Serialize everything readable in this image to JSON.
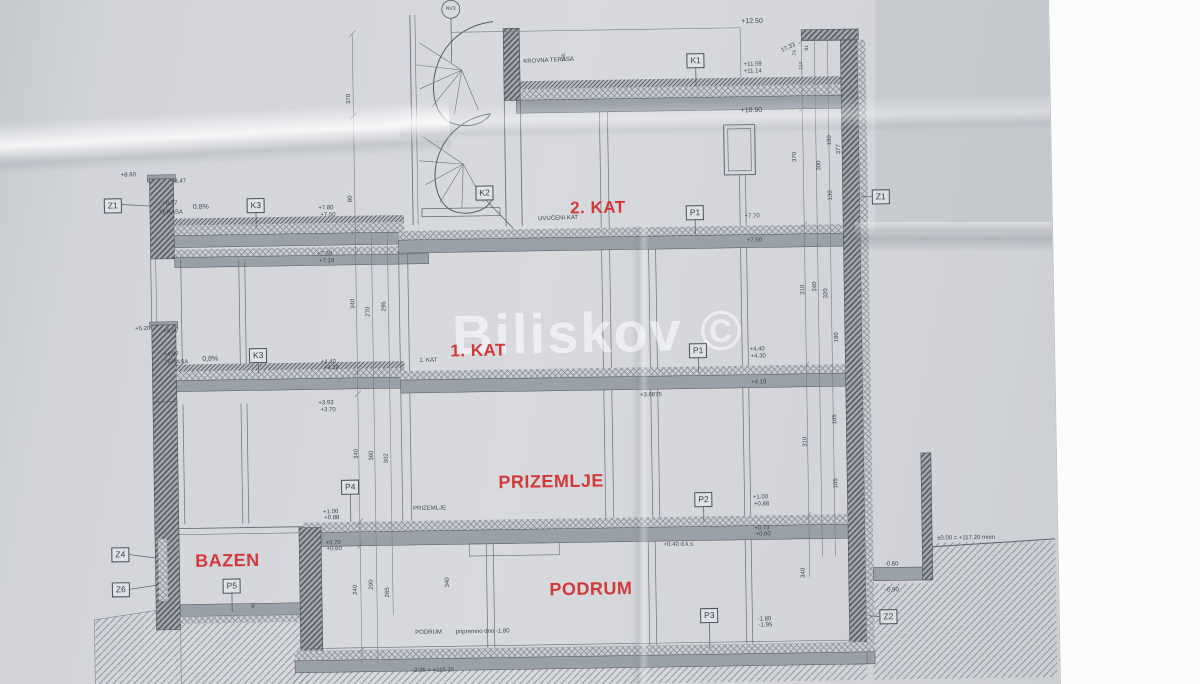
{
  "watermark": {
    "text": "Biliskov ©"
  },
  "colors": {
    "label_red": "#d23a3a",
    "line": "#60646c",
    "paper": "#d2d4d9"
  },
  "drawing": {
    "room_labels": [
      {
        "t": "2. KAT",
        "x": 600,
        "y": 208,
        "s": 17
      },
      {
        "t": "1. KAT",
        "x": 478,
        "y": 349,
        "s": 17
      },
      {
        "t": "PRIZEMLJE",
        "x": 549,
        "y": 481,
        "s": 18
      },
      {
        "t": "PODRUM",
        "x": 587,
        "y": 589,
        "s": 18
      },
      {
        "t": "BAZEN",
        "x": 224,
        "y": 555,
        "s": 18
      }
    ],
    "tags": [
      {
        "t": "K1",
        "x": 700,
        "y": 62
      },
      {
        "t": "K2",
        "x": 487,
        "y": 191
      },
      {
        "t": "K3",
        "x": 258,
        "y": 200
      },
      {
        "t": "K3",
        "x": 258,
        "y": 350
      },
      {
        "t": "P1",
        "x": 697,
        "y": 214
      },
      {
        "t": "P1",
        "x": 698,
        "y": 352
      },
      {
        "t": "P2",
        "x": 701,
        "y": 501
      },
      {
        "t": "P3",
        "x": 705,
        "y": 617
      },
      {
        "t": "P4",
        "x": 348,
        "y": 483
      },
      {
        "t": "P5",
        "x": 228,
        "y": 580
      },
      {
        "t": "Z1",
        "x": 115,
        "y": 198
      },
      {
        "t": "Z1",
        "x": 883,
        "y": 201
      },
      {
        "t": "Z4",
        "x": 117,
        "y": 547
      },
      {
        "t": "Z6",
        "x": 117,
        "y": 582
      },
      {
        "t": "Z2",
        "x": 884,
        "y": 621
      }
    ],
    "annotations": [
      {
        "t": "NV3",
        "x": 456,
        "y": 7,
        "s": 5
      },
      {
        "t": "KROVNA TERASA",
        "x": 553,
        "y": 60,
        "r": -2
      },
      {
        "t": "135",
        "x": 569,
        "y": 57,
        "r": -90,
        "s": 5
      },
      {
        "t": "UVUČENI KAT",
        "x": 560,
        "y": 218,
        "r": -1
      },
      {
        "t": "TERASA",
        "x": 173,
        "y": 206
      },
      {
        "t": "0,8%",
        "x": 203,
        "y": 201,
        "s": 7
      },
      {
        "t": "TERASA",
        "x": 176,
        "y": 356
      },
      {
        "t": "0,8%",
        "x": 210,
        "y": 353,
        "s": 7
      },
      {
        "t": "1. KAT",
        "x": 428,
        "y": 358
      },
      {
        "t": "PRIZEMLJE",
        "x": 427,
        "y": 506
      },
      {
        "t": "PODRUM",
        "x": 424,
        "y": 630
      },
      {
        "t": "pripremno dno -1,80",
        "x": 478,
        "y": 630
      },
      {
        "t": "+12.50",
        "x": 757,
        "y": 24,
        "s": 7
      },
      {
        "t": "17,33",
        "x": 793,
        "y": 51,
        "r": -25
      },
      {
        "t": "+11.59",
        "x": 757,
        "y": 67
      },
      {
        "t": "+11.14",
        "x": 757,
        "y": 74
      },
      {
        "t": "+10.90",
        "x": 755,
        "y": 113,
        "s": 7
      },
      {
        "t": "+8.60",
        "x": 131,
        "y": 168
      },
      {
        "t": "+8.47",
        "x": 181,
        "y": 175
      },
      {
        "t": "+8.37",
        "x": 172,
        "y": 197
      },
      {
        "t": "+7.80",
        "x": 328,
        "y": 204
      },
      {
        "t": "+7.50",
        "x": 330,
        "y": 211
      },
      {
        "t": "+7.30",
        "x": 326,
        "y": 250
      },
      {
        "t": "+7.10",
        "x": 328,
        "y": 257
      },
      {
        "t": "+7.70",
        "x": 754,
        "y": 219
      },
      {
        "t": "+7.50",
        "x": 756,
        "y": 243
      },
      {
        "t": "+5.20",
        "x": 143,
        "y": 322
      },
      {
        "t": "+5.07",
        "x": 171,
        "y": 325
      },
      {
        "t": "+4.97",
        "x": 171,
        "y": 348
      },
      {
        "t": "+4.40",
        "x": 328,
        "y": 358
      },
      {
        "t": "+4.10",
        "x": 331,
        "y": 364
      },
      {
        "t": "+3.93",
        "x": 325,
        "y": 399
      },
      {
        "t": "+3.70",
        "x": 327,
        "y": 406
      },
      {
        "t": "+4.40",
        "x": 757,
        "y": 352
      },
      {
        "t": "+4.30",
        "x": 758,
        "y": 359
      },
      {
        "t": "+4.10",
        "x": 758,
        "y": 385
      },
      {
        "t": "+3.8875",
        "x": 650,
        "y": 396
      },
      {
        "t": "+1.00",
        "x": 758,
        "y": 500
      },
      {
        "t": "+0.88",
        "x": 759,
        "y": 507
      },
      {
        "t": "+0.73",
        "x": 759,
        "y": 531
      },
      {
        "t": "+0.60",
        "x": 760,
        "y": 537
      },
      {
        "t": "+0.40 d.k.s.",
        "x": 676,
        "y": 546
      },
      {
        "t": "+1.00",
        "x": 328,
        "y": 508
      },
      {
        "t": "+0.88",
        "x": 329,
        "y": 514
      },
      {
        "t": "+0.70",
        "x": 330,
        "y": 539
      },
      {
        "t": "+0.60",
        "x": 331,
        "y": 545
      },
      {
        "t": "-1.80",
        "x": 760,
        "y": 622
      },
      {
        "t": "-1.95",
        "x": 761,
        "y": 628
      },
      {
        "t": "±0.00 = +117.20 mnm",
        "x": 963,
        "y": 544
      },
      {
        "t": "-0.60",
        "x": 888,
        "y": 569
      },
      {
        "t": "-0.90",
        "x": 888,
        "y": 595
      },
      {
        "t": "-2.05 = +115.15",
        "x": 428,
        "y": 668
      },
      {
        "t": "370",
        "x": 353,
        "y": 95,
        "r": -90
      },
      {
        "t": "80",
        "x": 353,
        "y": 195,
        "r": -90
      },
      {
        "t": "340",
        "x": 354,
        "y": 300,
        "r": -90
      },
      {
        "t": "270",
        "x": 369,
        "y": 308,
        "r": -90
      },
      {
        "t": "295",
        "x": 385,
        "y": 303,
        "r": -90
      },
      {
        "t": "340",
        "x": 355,
        "y": 450,
        "r": -90
      },
      {
        "t": "360",
        "x": 370,
        "y": 452,
        "r": -90
      },
      {
        "t": "302",
        "x": 385,
        "y": 455,
        "r": -90
      },
      {
        "t": "240",
        "x": 352,
        "y": 586,
        "r": -90
      },
      {
        "t": "290",
        "x": 368,
        "y": 581,
        "r": -90
      },
      {
        "t": "265",
        "x": 384,
        "y": 589,
        "r": -90
      },
      {
        "t": "340",
        "x": 444,
        "y": 580,
        "r": -90
      },
      {
        "t": "340",
        "x": 800,
        "y": 576,
        "r": -90
      },
      {
        "t": "370",
        "x": 798,
        "y": 160,
        "r": -90
      },
      {
        "t": "377",
        "x": 842,
        "y": 153,
        "r": -90
      },
      {
        "t": "300",
        "x": 822,
        "y": 169,
        "r": -90
      },
      {
        "t": "180",
        "x": 833,
        "y": 144,
        "r": -90
      },
      {
        "t": "130",
        "x": 833,
        "y": 199,
        "r": -90
      },
      {
        "t": "310",
        "x": 804,
        "y": 293,
        "r": -90
      },
      {
        "t": "340",
        "x": 816,
        "y": 290,
        "r": -90
      },
      {
        "t": "320",
        "x": 827,
        "y": 297,
        "r": -90
      },
      {
        "t": "180",
        "x": 837,
        "y": 341,
        "r": -90
      },
      {
        "t": "105",
        "x": 834,
        "y": 423,
        "r": -90
      },
      {
        "t": "310",
        "x": 804,
        "y": 445,
        "r": -90
      },
      {
        "t": "105",
        "x": 834,
        "y": 487,
        "r": -90
      },
      {
        "t": "74",
        "x": 800,
        "y": 56,
        "r": -90,
        "s": 5
      },
      {
        "t": "91",
        "x": 812,
        "y": 51,
        "r": -90,
        "s": 5
      },
      {
        "t": "114",
        "x": 806,
        "y": 69,
        "r": -90,
        "s": 5
      },
      {
        "t": "40",
        "x": 250,
        "y": 600,
        "r": -90,
        "s": 5
      }
    ]
  }
}
